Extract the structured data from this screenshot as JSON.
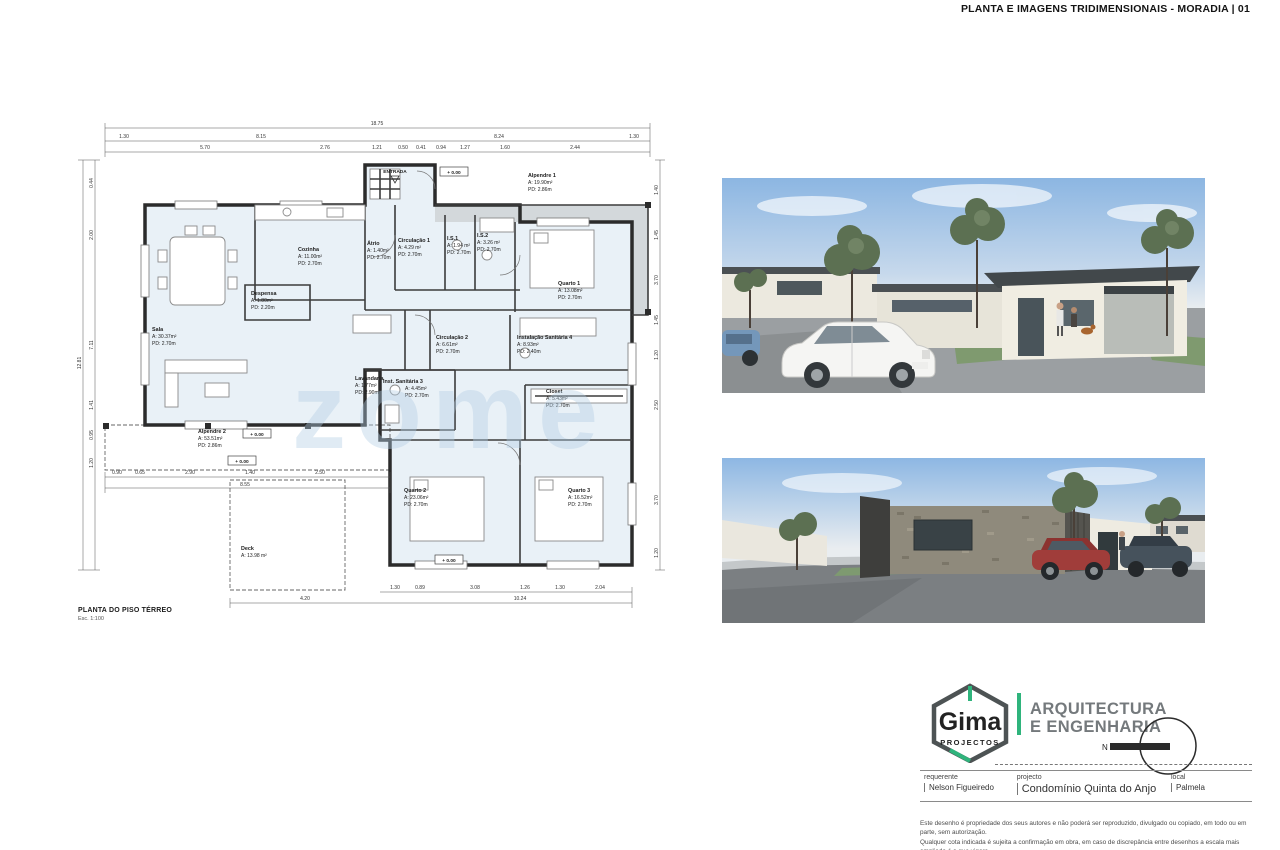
{
  "header": {
    "title": "PLANTA E IMAGENS TRIDIMENSIONAIS - MORADIA | 01"
  },
  "watermark": "zome",
  "plan": {
    "title": "PLANTA DO PISO TÉRREO",
    "scale": "Esc. 1:100",
    "entrance_label": "ENTRADA",
    "level_marker": "+ 0.00",
    "rooms": [
      {
        "name": "Sala",
        "area": "A:  30.37m²",
        "pd": "PD: 2.70m"
      },
      {
        "name": "Cozinha",
        "area": "A:  11.00m²",
        "pd": "PD: 2.70m"
      },
      {
        "name": "Despensa",
        "area": "A:  1.80m²",
        "pd": "PD: 2.20m"
      },
      {
        "name": "Átrio",
        "area": "A:  1.40m²",
        "pd": "PD: 2.70m"
      },
      {
        "name": "Circulação 1",
        "area": "A:  4.29 m²",
        "pd": "PD: 2.70m"
      },
      {
        "name": "I.S.1",
        "area": "A:  1.94 m²",
        "pd": "PD: 2.70m"
      },
      {
        "name": "I.S.2",
        "area": "A:  3.26 m²",
        "pd": "PD: 2.70m"
      },
      {
        "name": "Quarto 1",
        "area": "A:  13.08m²",
        "pd": "PD: 2.70m"
      },
      {
        "name": "Lavandaria",
        "area": "A:  1.77m²",
        "pd": "PD: 2.90m"
      },
      {
        "name": "Circulação 2",
        "area": "A:  6.61m²",
        "pd": "PD: 2.70m"
      },
      {
        "name": "Instalação Sanitária 4",
        "area": "A:  8.93m²",
        "pd": "PD: 2.40m"
      },
      {
        "name": "Inst. Sanitária 3",
        "area": "A:  4.45m²",
        "pd": "PD: 2.70m"
      },
      {
        "name": "Closet",
        "area": "A:  5.43m²",
        "pd": "PD: 2.70m"
      },
      {
        "name": "Quarto 2",
        "area": "A:  23.06m²",
        "pd": "PD: 2.70m"
      },
      {
        "name": "Quarto 3",
        "area": "A:  16.52m²",
        "pd": "PD: 2.70m"
      },
      {
        "name": "Alpendre 1",
        "area": "A:  19.90m²",
        "pd": "PD: 2.86m"
      },
      {
        "name": "Alpendre 2",
        "area": "A:  53.51m²",
        "pd": "PD: 2.86m"
      },
      {
        "name": "Deck",
        "area": "A:  13.98 m²",
        "pd": ""
      }
    ],
    "dims": {
      "top1": "18.75",
      "top2": [
        "1.30",
        "8.15",
        "8.24",
        "1.30"
      ],
      "top3": [
        "5.70",
        "2.76",
        "1.21",
        "0.50",
        "0.41",
        "0.94",
        "1.27",
        "1.60",
        "2.44"
      ],
      "left": [
        "0.44",
        "2.00",
        "7.11",
        "1.41",
        "0.95",
        "1.20",
        "12.81"
      ],
      "right": [
        "1.40",
        "1.45",
        "3.70",
        "1.45",
        "1.20",
        "2.50",
        "3.70",
        "1.20"
      ],
      "bottom1": [
        "0.90",
        "0.65",
        "2.90",
        "1.40",
        "2.50"
      ],
      "bottom2": "8.55",
      "bottom3": [
        "1.30",
        "0.89",
        "3.08",
        "1.26",
        "1.30",
        "2.04"
      ],
      "bottom4": [
        "4.20",
        "10.24"
      ]
    }
  },
  "branding": {
    "logo_name": "Gima",
    "logo_sub": "PROJECTOS",
    "tagline_line1": "ARQUITECTURA",
    "tagline_line2": "E ENGENHARIA",
    "north_label": "N"
  },
  "titleblock": {
    "fields": [
      {
        "label": "requerente",
        "value": "Nelson Figueiredo"
      },
      {
        "label": "projecto",
        "value": "Condomínio Quinta do Anjo"
      },
      {
        "label": "local",
        "value": "Palmela"
      }
    ],
    "disclaimer_line1": "Este desenho é propriedade dos seus autores e não poderá ser reproduzido, divulgado ou copiado, em todo ou em parte, sem autorização.",
    "disclaimer_line2": "Qualquer cota indicada é sujeita a confirmação em obra, em caso de discrepância entre desenhos a escala mais ampliada é a que vigora."
  },
  "colors": {
    "accent_green": "#2fb47c",
    "plan_room_fill": "#e9f1f7",
    "porch_fill": "#d3d8db",
    "sky_blue": "#8cb6e2",
    "asphalt_gray": "#9b9fa2",
    "red_car": "#a03d3a"
  }
}
